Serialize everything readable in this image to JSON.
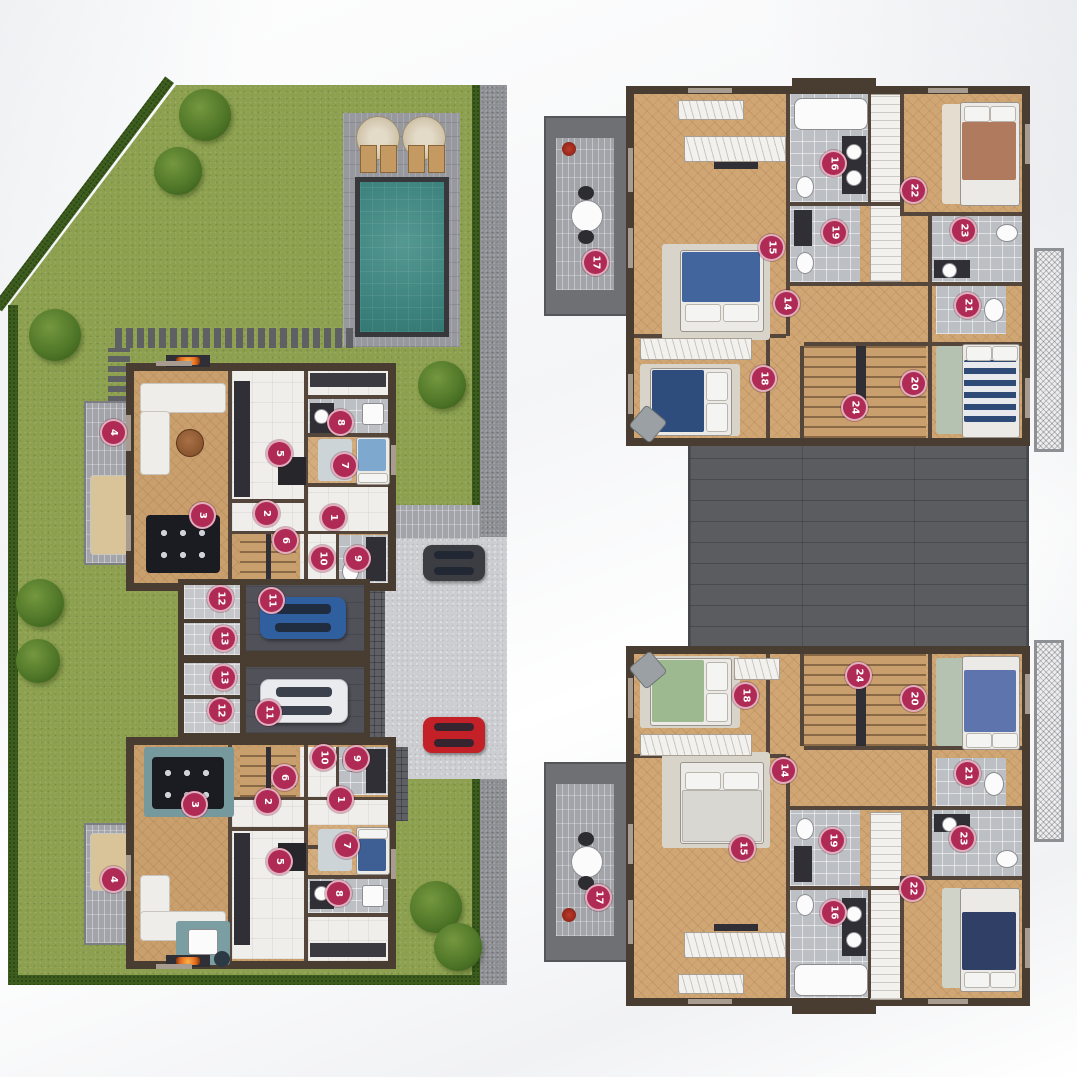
{
  "document": {
    "type": "residential floor plans",
    "views": [
      "ground floor site plan with garden, pool and parking",
      "upper floor plan of two mirrored units"
    ]
  },
  "palette": {
    "badge": "#b02a56",
    "grass": "#8ca04f",
    "hedge": "#3c5d1e",
    "pool_water": "#3e8a84",
    "wall": "#493c30",
    "wood_floor": "#c99f6e",
    "roof": "#5a5c5f",
    "car_blue": "#2f5f9f",
    "car_white": "#e9ebee",
    "car_red": "#c32127",
    "car_dark": "#3c3d42",
    "bed_blue": "#41659c",
    "bed_navy": "#2e4d7d",
    "bed_green": "#9cb98f",
    "bed_brown": "#b07a5e"
  },
  "plans": [
    {
      "id": "site-plan",
      "badges": [
        {
          "n": "4",
          "x": 105,
          "y": 347
        },
        {
          "n": "3",
          "x": 194,
          "y": 430
        },
        {
          "n": "5",
          "x": 271,
          "y": 368
        },
        {
          "n": "8",
          "x": 332,
          "y": 337
        },
        {
          "n": "7",
          "x": 336,
          "y": 380
        },
        {
          "n": "2",
          "x": 258,
          "y": 428
        },
        {
          "n": "1",
          "x": 325,
          "y": 432
        },
        {
          "n": "6",
          "x": 277,
          "y": 455
        },
        {
          "n": "10",
          "x": 314,
          "y": 473
        },
        {
          "n": "9",
          "x": 349,
          "y": 473
        },
        {
          "n": "12",
          "x": 212,
          "y": 513
        },
        {
          "n": "11",
          "x": 263,
          "y": 515
        },
        {
          "n": "13",
          "x": 215,
          "y": 553
        },
        {
          "n": "13",
          "x": 215,
          "y": 592
        },
        {
          "n": "12",
          "x": 212,
          "y": 625
        },
        {
          "n": "11",
          "x": 260,
          "y": 627
        },
        {
          "n": "10",
          "x": 315,
          "y": 672
        },
        {
          "n": "9",
          "x": 348,
          "y": 673
        },
        {
          "n": "6",
          "x": 276,
          "y": 692
        },
        {
          "n": "2",
          "x": 259,
          "y": 716
        },
        {
          "n": "1",
          "x": 332,
          "y": 714
        },
        {
          "n": "3",
          "x": 186,
          "y": 719
        },
        {
          "n": "5",
          "x": 271,
          "y": 776
        },
        {
          "n": "7",
          "x": 338,
          "y": 760
        },
        {
          "n": "8",
          "x": 330,
          "y": 808
        },
        {
          "n": "4",
          "x": 105,
          "y": 794
        }
      ]
    },
    {
      "id": "upper-plan",
      "badges": [
        {
          "n": "17",
          "x": 57,
          "y": 184
        },
        {
          "n": "16",
          "x": 295,
          "y": 85
        },
        {
          "n": "22",
          "x": 375,
          "y": 112
        },
        {
          "n": "19",
          "x": 296,
          "y": 154
        },
        {
          "n": "23",
          "x": 425,
          "y": 152
        },
        {
          "n": "15",
          "x": 233,
          "y": 169
        },
        {
          "n": "14",
          "x": 248,
          "y": 225
        },
        {
          "n": "21",
          "x": 429,
          "y": 227
        },
        {
          "n": "18",
          "x": 225,
          "y": 300
        },
        {
          "n": "20",
          "x": 375,
          "y": 305
        },
        {
          "n": "24",
          "x": 316,
          "y": 329
        },
        {
          "n": "18",
          "x": 207,
          "y": 617
        },
        {
          "n": "24",
          "x": 320,
          "y": 597
        },
        {
          "n": "20",
          "x": 375,
          "y": 620
        },
        {
          "n": "14",
          "x": 245,
          "y": 692
        },
        {
          "n": "21",
          "x": 429,
          "y": 695
        },
        {
          "n": "15",
          "x": 204,
          "y": 770
        },
        {
          "n": "19",
          "x": 294,
          "y": 762
        },
        {
          "n": "23",
          "x": 424,
          "y": 760
        },
        {
          "n": "17",
          "x": 60,
          "y": 819
        },
        {
          "n": "16",
          "x": 295,
          "y": 834
        },
        {
          "n": "22",
          "x": 374,
          "y": 810
        }
      ]
    }
  ]
}
